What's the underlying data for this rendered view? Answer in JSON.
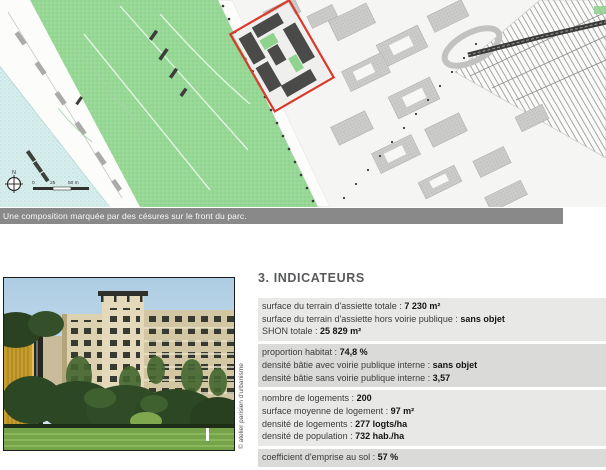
{
  "map": {
    "caption": "Une composition marquée par des césures sur le front du parc.",
    "north_label": "N",
    "scale": {
      "tick0": "0",
      "tick1": "25",
      "tick2": "50 m"
    },
    "colors": {
      "water": "#d8eeed",
      "park": "#97d897",
      "urban_block": "#cbcbc9",
      "red_outline": "#d93a2c",
      "caption_bar": "#898989"
    }
  },
  "photo": {
    "credit": "© atelier parisien d'urbanisme"
  },
  "indicators": {
    "title": "3. INDICATEURS",
    "groups": [
      {
        "rows": [
          {
            "label": "surface du terrain d'assiette totale :",
            "value": "7 230 m²"
          },
          {
            "label": "surface du terrain d'assiette hors voirie publique :",
            "value": "sans objet"
          },
          {
            "label": "SHON totale :",
            "value": "25 829 m²"
          }
        ]
      },
      {
        "rows": [
          {
            "label": "proportion habitat :",
            "value": "74,8 %"
          },
          {
            "label": "densité bâtie avec voirie publique interne :",
            "value": "sans objet"
          },
          {
            "label": "densité bâtie sans voirie publique interne :",
            "value": "3,57"
          }
        ]
      },
      {
        "rows": [
          {
            "label": "nombre de logements :",
            "value": "200"
          },
          {
            "label": "surface moyenne de logement :",
            "value": "97 m²"
          },
          {
            "label": "densité de logements :",
            "value": "277 logts/ha"
          },
          {
            "label": "densité de population :",
            "value": "732 hab./ha"
          }
        ]
      },
      {
        "rows": [
          {
            "label": "coefficient d'emprise au sol :",
            "value": "57 %"
          }
        ]
      }
    ]
  }
}
